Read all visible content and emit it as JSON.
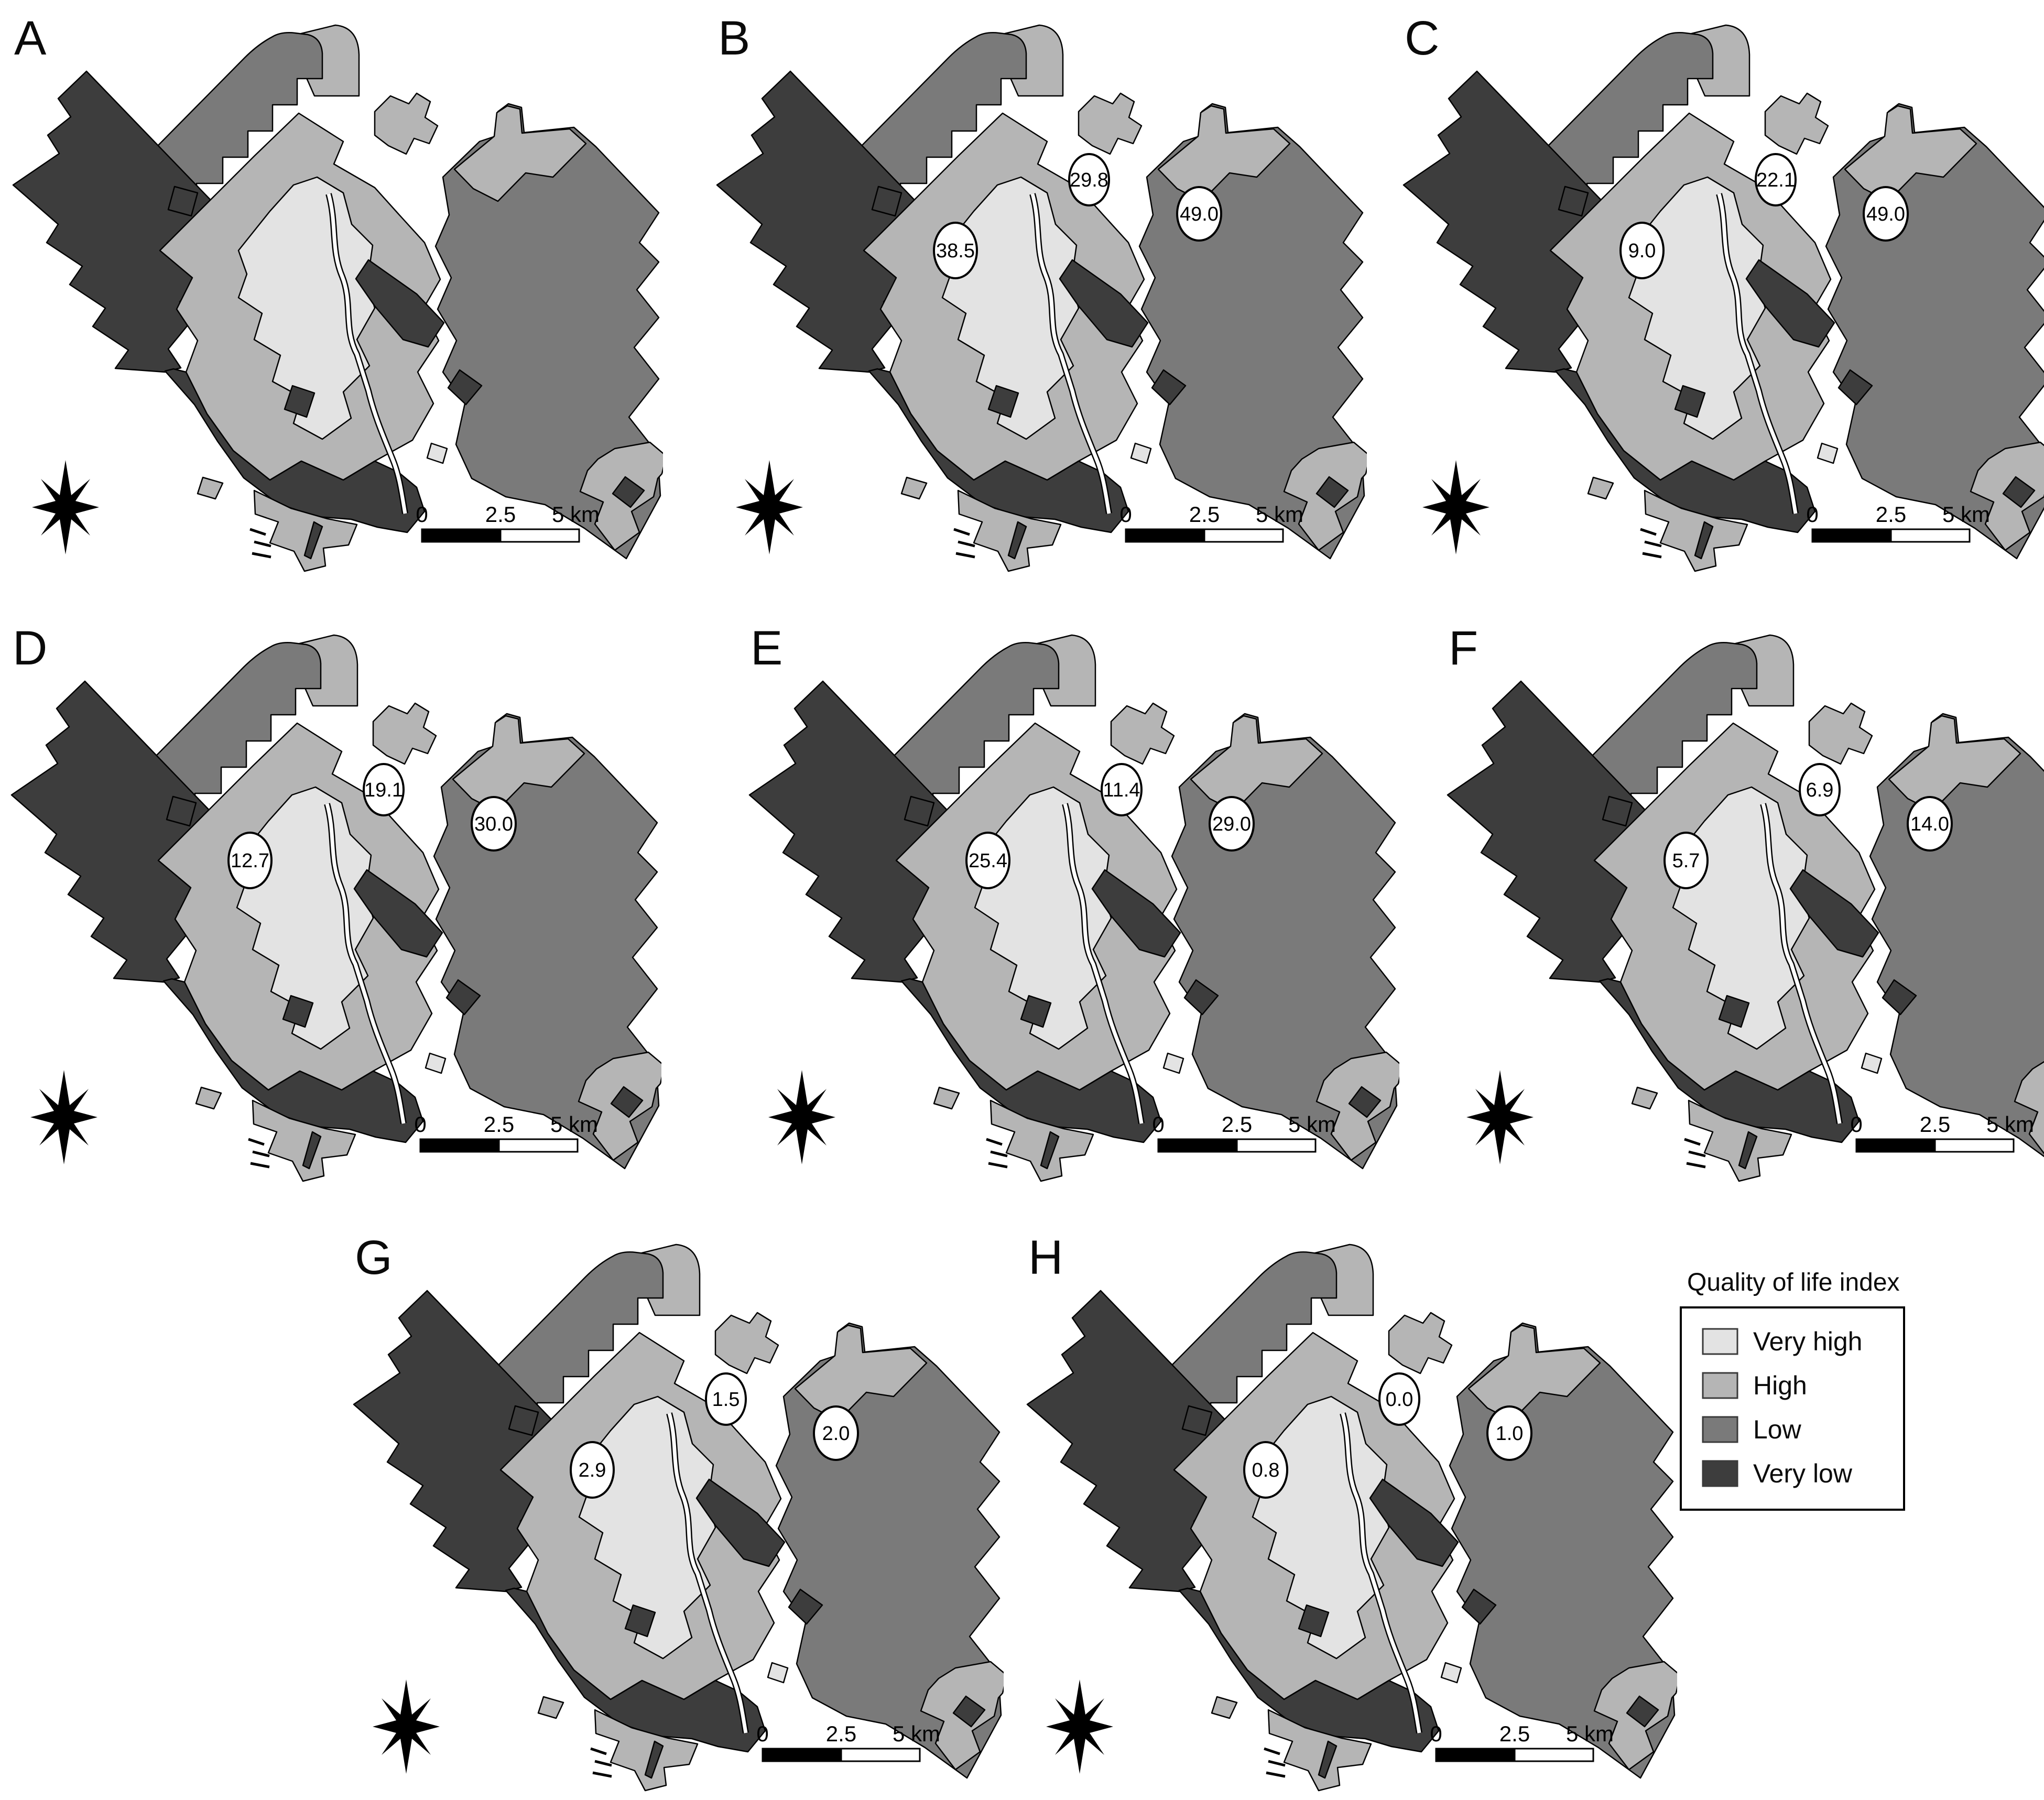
{
  "figure": {
    "type": "choropleth-map-panel-figure",
    "background": "#ffffff",
    "description_visible_text_only": true
  },
  "panels": [
    {
      "id": "A",
      "label": "A",
      "values": [
        null,
        null,
        null
      ]
    },
    {
      "id": "B",
      "label": "B",
      "values": [
        "38.5",
        "29.8",
        "49.0"
      ]
    },
    {
      "id": "C",
      "label": "C",
      "values": [
        "9.0",
        "22.1",
        "49.0"
      ]
    },
    {
      "id": "D",
      "label": "D",
      "values": [
        "12.7",
        "19.1",
        "30.0"
      ]
    },
    {
      "id": "E",
      "label": "E",
      "values": [
        "25.4",
        "11.4",
        "29.0"
      ]
    },
    {
      "id": "F",
      "label": "F",
      "values": [
        "5.7",
        "6.9",
        "14.0"
      ]
    },
    {
      "id": "G",
      "label": "G",
      "values": [
        "2.9",
        "1.5",
        "2.0"
      ]
    },
    {
      "id": "H",
      "label": "H",
      "values": [
        "0.8",
        "0.0",
        "1.0"
      ]
    }
  ],
  "legend": {
    "title": "Quality of life index",
    "items": [
      {
        "label": "Very high",
        "color": "#e3e3e3"
      },
      {
        "label": "High",
        "color": "#b5b5b5"
      },
      {
        "label": "Low",
        "color": "#7a7a7a"
      },
      {
        "label": "Very low",
        "color": "#3d3d3d"
      }
    ]
  },
  "scale_bar": {
    "labels": [
      "0",
      "2.5",
      "5 km"
    ]
  },
  "north_arrow": {
    "icon": "compass-rose-icon"
  },
  "map_colors": {
    "very_high": "#e3e3e3",
    "high": "#b5b5b5",
    "low": "#7a7a7a",
    "very_low": "#3d3d3d",
    "water": "#ffffff",
    "outline": "#000000"
  }
}
